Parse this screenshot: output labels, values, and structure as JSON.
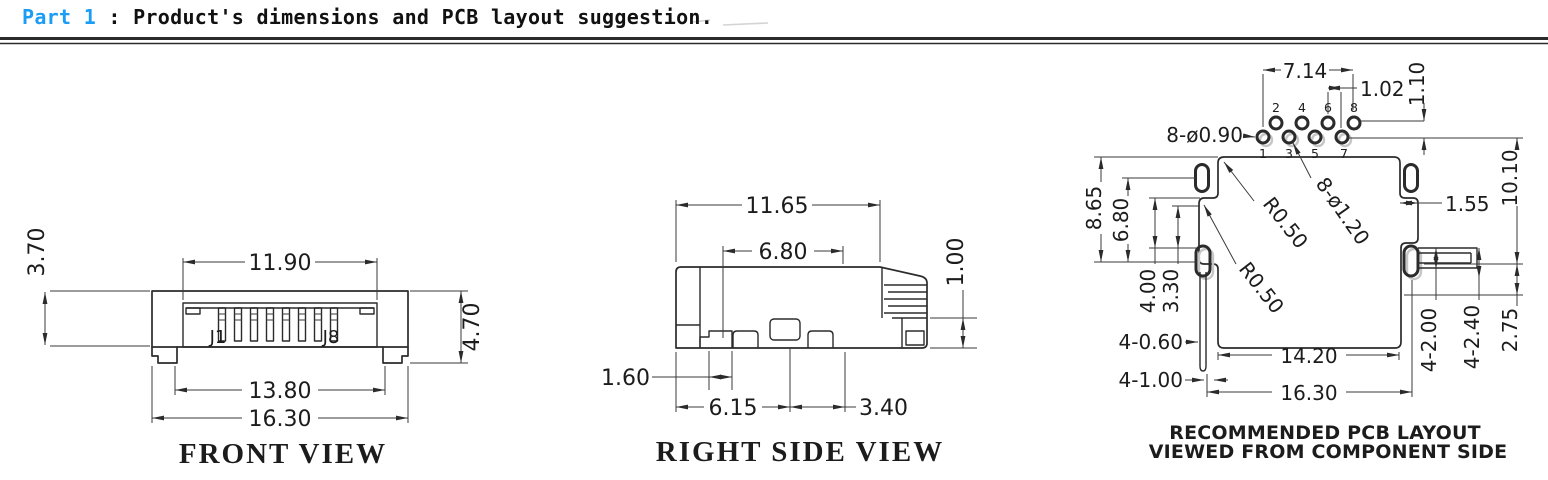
{
  "header": {
    "part_label": "Part 1",
    "colon": ":",
    "title": "Product's dimensions and PCB layout suggestion.",
    "accent_color": "#1b9cf5",
    "text_color": "#111111"
  },
  "front_view": {
    "caption": "FRONT VIEW",
    "pin_labels": {
      "first": "J1",
      "last": "J8"
    },
    "dims": {
      "pin_span": "11.90",
      "body_height": "3.70",
      "total_height": "4.70",
      "inner_width": "13.80",
      "body_width": "16.30"
    }
  },
  "right_side_view": {
    "caption": "RIGHT SIDE VIEW",
    "dims": {
      "total_depth": "11.65",
      "upper_depth": "6.80",
      "tab_height": "1.00",
      "notch_width": "1.60",
      "front_depth": "6.15",
      "rear_depth": "3.40"
    }
  },
  "pcb_layout": {
    "caption_line1": "RECOMMENDED PCB LAYOUT",
    "caption_line2": "VIEWED FROM COMPONENT SIDE",
    "pin_numbers_top": [
      "2",
      "4",
      "6",
      "8"
    ],
    "pin_numbers_bottom": [
      "1",
      "3",
      "5",
      "7"
    ],
    "dims": {
      "pin_span": "7.14",
      "pin_pitch": "1.02",
      "row_offset": "1.10",
      "holes_small": "8-ø0.90",
      "holes_large": "8-ø1.20",
      "fillet_1": "R0.50",
      "fillet_2": "R0.50",
      "flange_height": "8.65",
      "slot_offset": "6.80",
      "step_offset": "4.00",
      "slot_height": "3.30",
      "side_slot_width": "1.55",
      "overall_height": "10.10",
      "narrow_slots": "4-0.60",
      "wide_slots": "4-1.00",
      "body_width": "14.20",
      "overall_width": "16.30",
      "tab_slot_height": "4-2.00",
      "tab_slot_width": "4-2.40",
      "tab_offset": "2.75"
    }
  }
}
